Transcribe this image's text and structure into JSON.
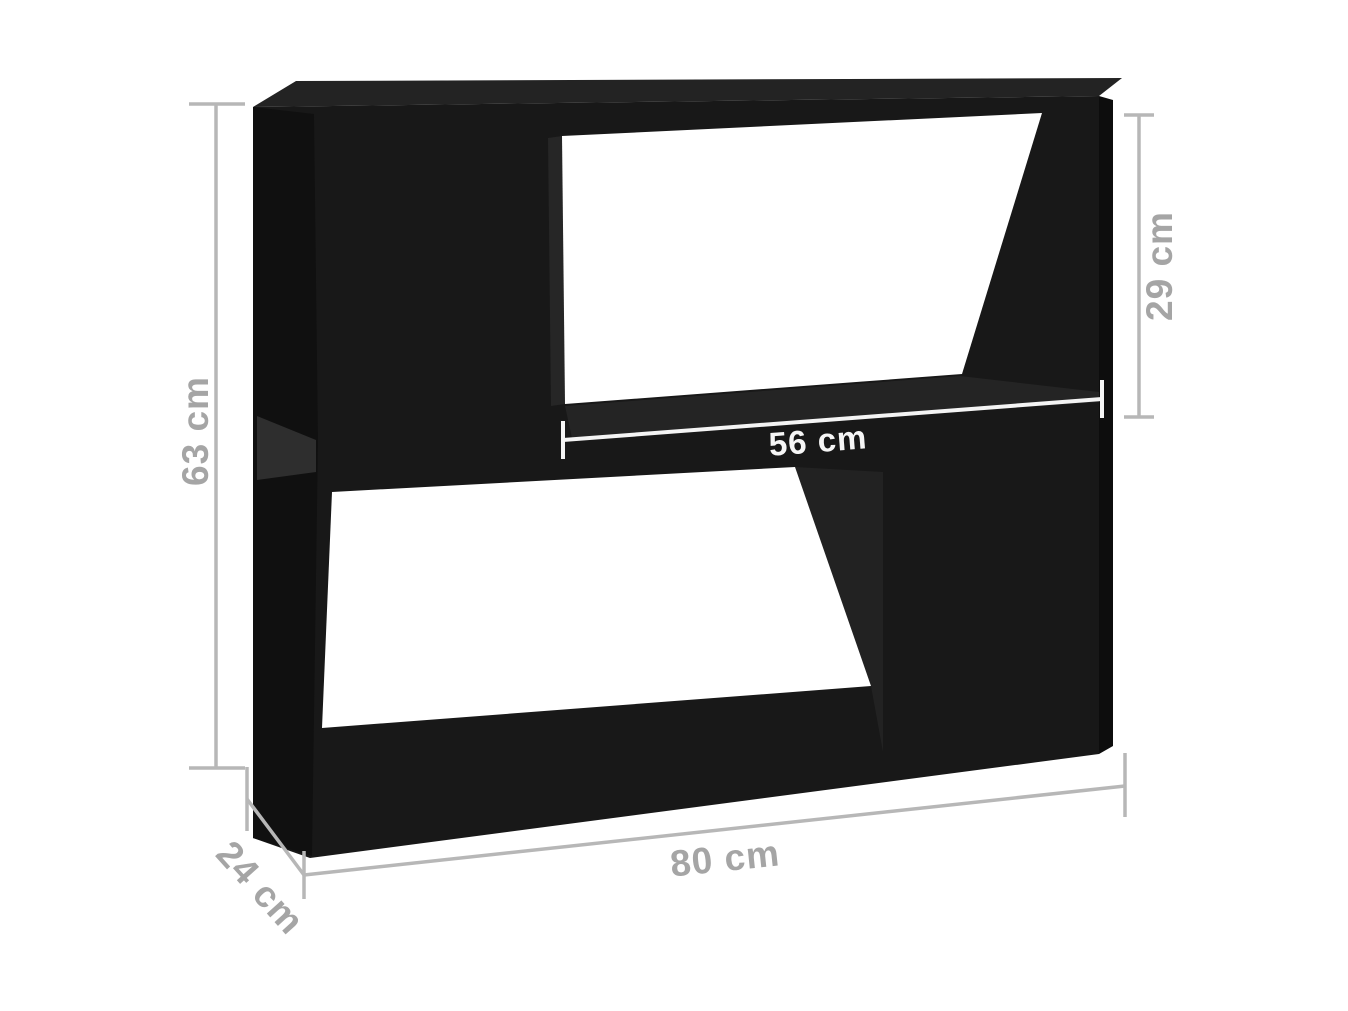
{
  "figure": {
    "background": "#ffffff",
    "subject": "Black cabinet shelf unit rendered in perspective with measurement annotations",
    "style": "product dimension diagram"
  },
  "cabinet": {
    "color_front": "#181818",
    "color_top": "#232323",
    "color_side": "#0d0d0d",
    "openings": "two open through-compartments (top-right, bottom-left)"
  },
  "dimension_style": {
    "line_color": "#b7b7b7",
    "text_color": "#a5a5a5",
    "inner_line_color": "#f4f4f4",
    "inner_text_color": "#f6f6f6"
  },
  "dimensions": {
    "height": {
      "label": "63 cm",
      "value": 63,
      "unit": "cm",
      "measures": "overall height",
      "orientation": "vertical"
    },
    "opening_height": {
      "label": "29 cm",
      "value": 29,
      "unit": "cm",
      "measures": "upper compartment height",
      "orientation": "vertical"
    },
    "opening_width": {
      "label": "56 cm",
      "value": 56,
      "unit": "cm",
      "measures": "upper compartment width",
      "orientation": "horizontal"
    },
    "width": {
      "label": "80 cm",
      "value": 80,
      "unit": "cm",
      "measures": "overall width",
      "orientation": "horizontal"
    },
    "depth": {
      "label": "24 cm",
      "value": 24,
      "unit": "cm",
      "measures": "overall depth",
      "orientation": "diagonal"
    }
  }
}
